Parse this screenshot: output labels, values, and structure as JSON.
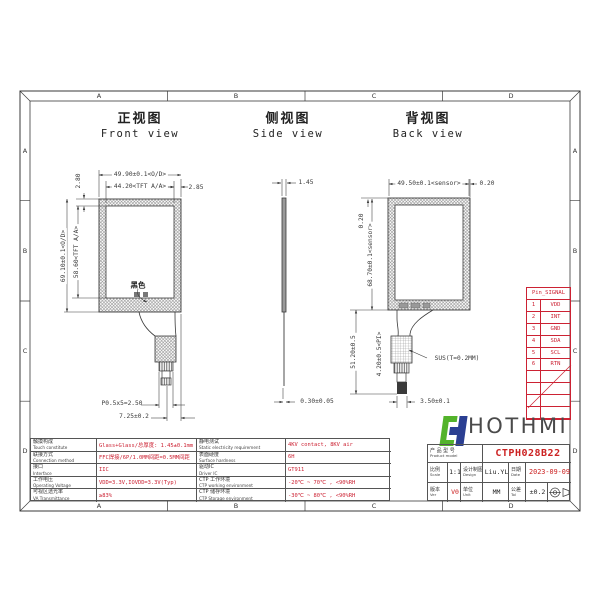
{
  "colors": {
    "red": "#cc2222",
    "line": "#3a3a3a",
    "logo_green": "#53b32b",
    "logo_blue": "#2b3f92",
    "brand_gray": "#4a4a4a"
  },
  "sheet": {
    "zones": [
      "A",
      "B",
      "C",
      "D"
    ]
  },
  "views": {
    "front": {
      "title_cn": "正视图",
      "title_en": "Front view",
      "black_label": "黑色",
      "dims": {
        "od_w": "49.90±0.1<O/D>",
        "aa_w": "44.20<TFT A/A>",
        "right_border": "2.85",
        "top_border": "2.80",
        "od_h": "69.10±0.1<O/D>",
        "aa_h": "58.60<TFT A/A>",
        "pitch": "P0.5x5=2.50",
        "tail": "7.25±0.2"
      }
    },
    "side": {
      "title_cn": "侧视图",
      "title_en": "Side view",
      "dims": {
        "thickness": "1.45",
        "glass": "0.30±0.05"
      }
    },
    "back": {
      "title_cn": "背视图",
      "title_en": "Back view",
      "sus_label": "SUS(T=0.2MM)",
      "dims": {
        "sensor_w": "49.50±0.1<sensor>",
        "left_offset": "0.20",
        "right_offset": "0.20",
        "sensor_h": "68.70±0.1<sensor>",
        "tail_len": "51.20±0.5",
        "pi": "4.20±0.5<PI>",
        "bottom": "3.50±0.1"
      }
    }
  },
  "pin_table": {
    "header": "Pin_SIGNAL",
    "pins": [
      {
        "no": "1",
        "signal": "VDD"
      },
      {
        "no": "2",
        "signal": "INT"
      },
      {
        "no": "3",
        "signal": "GND"
      },
      {
        "no": "4",
        "signal": "SDA"
      },
      {
        "no": "5",
        "signal": "SCL"
      },
      {
        "no": "6",
        "signal": "RTN"
      }
    ]
  },
  "spec_table": {
    "rows": [
      {
        "l1c": "触摸构成",
        "l1e": "Touch constitute",
        "v1": "Glass+Glass/总厚度: 1.45±0.1mm",
        "l2c": "静电测试",
        "l2e": "Static electricity requirement",
        "v2": "4KV contact, 8KV air"
      },
      {
        "l1c": "联接方式",
        "l1e": "Connection method",
        "v1": "FFC焊接/6P/1.0MM间距=0.5MM间距",
        "l2c": "表面硬度",
        "l2e": "Surface hardness",
        "v2": "6H"
      },
      {
        "l1c": "接口",
        "l1e": "Interface",
        "v1": "IIC",
        "l2c": "驱动IC",
        "l2e": "Driver IC",
        "v2": "GT911"
      },
      {
        "l1c": "工作电压",
        "l1e": "Operating Voltage",
        "v1": "VDD=3.3V,IOVDD=3.3V(Typ)",
        "l2c": "CTP 工作环境",
        "l2e": "CTP working environment",
        "v2": "-20℃ ~ 70℃ , <90%RH"
      },
      {
        "l1c": "可视区透光率",
        "l1e": "VA Transmittance",
        "v1": "≥83%",
        "l2c": "CTP 储存环境",
        "l2e": "CTP Storage environment",
        "v2": "-30℃ ~ 80℃ , <90%RH"
      }
    ]
  },
  "title_block": {
    "brand": "HOTHMI",
    "product_label_cn": "产 品 型 号",
    "product_label_en": "Product model",
    "model": "CTPH028B22",
    "scale_cn": "比例",
    "scale_en": "Scale",
    "scale": "1:1",
    "design_cn": "设计制图",
    "design_en": "Design",
    "designer": "Liu.YL",
    "date_cn": "日期",
    "date_en": "Date",
    "date": "2023-09-09",
    "ver_cn": "版本",
    "ver_en": "Ver",
    "version": "V0",
    "unit_cn": "单位",
    "unit_en": "Unit",
    "unit": "MM",
    "tol_cn": "公差",
    "tol_en": "Tol",
    "tolerance": "±0.2"
  }
}
